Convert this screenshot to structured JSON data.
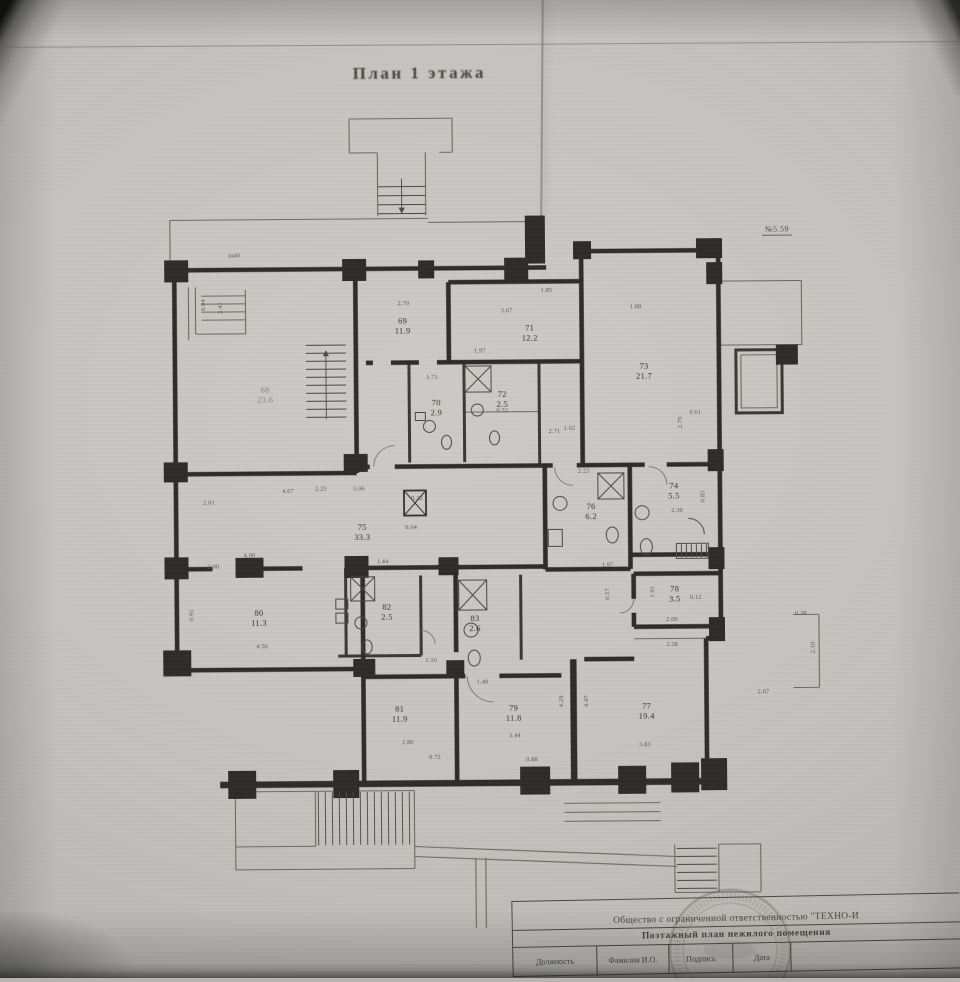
{
  "page": {
    "title": "План 1 этажа",
    "sheet_note": "№5.59"
  },
  "plan": {
    "rooms": [
      {
        "num": "68",
        "area": "23.6",
        "x": 266,
        "y": 384,
        "faint": true
      },
      {
        "num": "69",
        "area": "11.9",
        "x": 404,
        "y": 316
      },
      {
        "num": "71",
        "area": "12.2",
        "x": 531,
        "y": 324
      },
      {
        "num": "73",
        "area": "21.7",
        "x": 645,
        "y": 363
      },
      {
        "num": "70",
        "area": "2.9",
        "x": 437,
        "y": 398
      },
      {
        "num": "72",
        "area": "2.5",
        "x": 503,
        "y": 390
      },
      {
        "num": "74",
        "area": "5.5",
        "x": 674,
        "y": 483
      },
      {
        "num": "76",
        "area": "6.2",
        "x": 591,
        "y": 503
      },
      {
        "num": "75",
        "area": "33.3",
        "x": 362,
        "y": 522
      },
      {
        "num": "78",
        "area": "3.5",
        "x": 674,
        "y": 586
      },
      {
        "num": "80",
        "area": "11.3",
        "x": 258,
        "y": 607
      },
      {
        "num": "82",
        "area": "2.5",
        "x": 386,
        "y": 602
      },
      {
        "num": "83",
        "area": "2.6",
        "x": 474,
        "y": 614
      },
      {
        "num": "81",
        "area": "11.9",
        "x": 398,
        "y": 704
      },
      {
        "num": "79",
        "area": "11.8",
        "x": 512,
        "y": 704
      },
      {
        "num": "77",
        "area": "19.4",
        "x": 645,
        "y": 703
      }
    ],
    "dims": [
      {
        "t": "ш40",
        "x": 236,
        "y": 254
      },
      {
        "t": "0.94",
        "x": 205,
        "y": 303,
        "r": 90
      },
      {
        "t": "2.41",
        "x": 222,
        "y": 306,
        "r": 90
      },
      {
        "t": "2.70",
        "x": 405,
        "y": 303
      },
      {
        "t": "1.85",
        "x": 548,
        "y": 291
      },
      {
        "t": "3.67",
        "x": 508,
        "y": 311
      },
      {
        "t": "1.88",
        "x": 637,
        "y": 308
      },
      {
        "t": "1.97",
        "x": 481,
        "y": 351
      },
      {
        "t": "1.71",
        "x": 433,
        "y": 377
      },
      {
        "t": "0.52",
        "x": 503,
        "y": 411
      },
      {
        "t": "1.02",
        "x": 570,
        "y": 429
      },
      {
        "t": "2.71",
        "x": 555,
        "y": 432
      },
      {
        "t": "0.61",
        "x": 696,
        "y": 414
      },
      {
        "t": "2.79",
        "x": 681,
        "y": 424,
        "r": 90
      },
      {
        "t": "2.23",
        "x": 584,
        "y": 472
      },
      {
        "t": "2.30",
        "x": 677,
        "y": 512
      },
      {
        "t": "0.85",
        "x": 703,
        "y": 498,
        "r": 90
      },
      {
        "t": "0.22",
        "x": 417,
        "y": 498
      },
      {
        "t": "0.64",
        "x": 411,
        "y": 527
      },
      {
        "t": "4.67",
        "x": 288,
        "y": 490
      },
      {
        "t": "2.01",
        "x": 209,
        "y": 501
      },
      {
        "t": "2.25",
        "x": 321,
        "y": 488
      },
      {
        "t": "5.06",
        "x": 359,
        "y": 488
      },
      {
        "t": "1.44",
        "x": 382,
        "y": 561
      },
      {
        "t": "4.90",
        "x": 249,
        "y": 554
      },
      {
        "t": "2.00",
        "x": 213,
        "y": 565
      },
      {
        "t": "0.91",
        "x": 191,
        "y": 613,
        "r": 90
      },
      {
        "t": "4.56",
        "x": 261,
        "y": 645
      },
      {
        "t": "1.16",
        "x": 430,
        "y": 660
      },
      {
        "t": "1.97",
        "x": 607,
        "y": 566
      },
      {
        "t": "1.91",
        "x": 652,
        "y": 593,
        "r": 90
      },
      {
        "t": "0.12",
        "x": 695,
        "y": 599
      },
      {
        "t": "2.00",
        "x": 671,
        "y": 621
      },
      {
        "t": "2.28",
        "x": 671,
        "y": 646
      },
      {
        "t": "0.57",
        "x": 607,
        "y": 595,
        "r": 90
      },
      {
        "t": "1.40",
        "x": 481,
        "y": 682
      },
      {
        "t": "2.86",
        "x": 406,
        "y": 742
      },
      {
        "t": "3.44",
        "x": 513,
        "y": 736
      },
      {
        "t": "3.83",
        "x": 643,
        "y": 746
      },
      {
        "t": "0.72",
        "x": 433,
        "y": 757
      },
      {
        "t": "0.88",
        "x": 530,
        "y": 760
      },
      {
        "t": "4.29",
        "x": 560,
        "y": 702,
        "r": 90
      },
      {
        "t": "4.47",
        "x": 585,
        "y": 702,
        "r": 90
      },
      {
        "t": "0.38",
        "x": 800,
        "y": 616
      },
      {
        "t": "2.10",
        "x": 812,
        "y": 650,
        "r": 90
      },
      {
        "t": "2.67",
        "x": 762,
        "y": 694
      }
    ]
  },
  "title_block": {
    "org": "Общество с ограниченной ответственностью \"ТЕХНО-И",
    "doc_title": "Поэтажный план нежилого помещения",
    "columns": [
      "Должность",
      "Фамилия И.О.",
      "Подпись",
      "Дата"
    ]
  }
}
